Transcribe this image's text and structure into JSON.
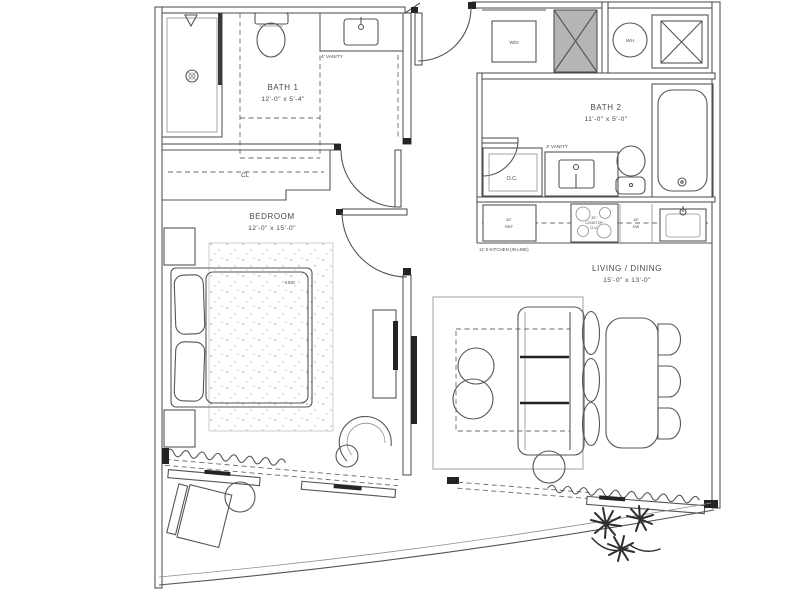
{
  "title": "Residential unit floor plan",
  "colors": {
    "line": "#555555",
    "wall": "#474747",
    "shaft_fill": "#b5b5b5",
    "dark_fixture": "#242424",
    "background": "#ffffff"
  },
  "rooms": {
    "bath1": {
      "name": "BATH 1",
      "dims": "12'-0\" x 5'-4\""
    },
    "bath2": {
      "name": "BATH 2",
      "dims": "11'-0\" x 5'-0\""
    },
    "bedroom": {
      "name": "BEDROOM",
      "dims": "12'-0\" x 15'-0\""
    },
    "living": {
      "name": "LIVING / DINING",
      "dims": "15'-0\" x 13'-0\""
    }
  },
  "labels": {
    "closet": "CL",
    "owners_closet": "O.C.",
    "washer_dryer": "W/D",
    "water_heater": "WH",
    "vanity1": "4' VANITY",
    "vanity2": "3' VANITY",
    "bed_size": "KING",
    "fridge_size": "30\"",
    "fridge": "REF",
    "cooktop_size": "30\"",
    "cooktop": "COOKTOP",
    "cooktop_note": "O.U.",
    "dishwasher_size": "18\"",
    "dishwasher": "DW",
    "kitchen_note": "11'-0 KITCHEN (IN-LINE)"
  }
}
